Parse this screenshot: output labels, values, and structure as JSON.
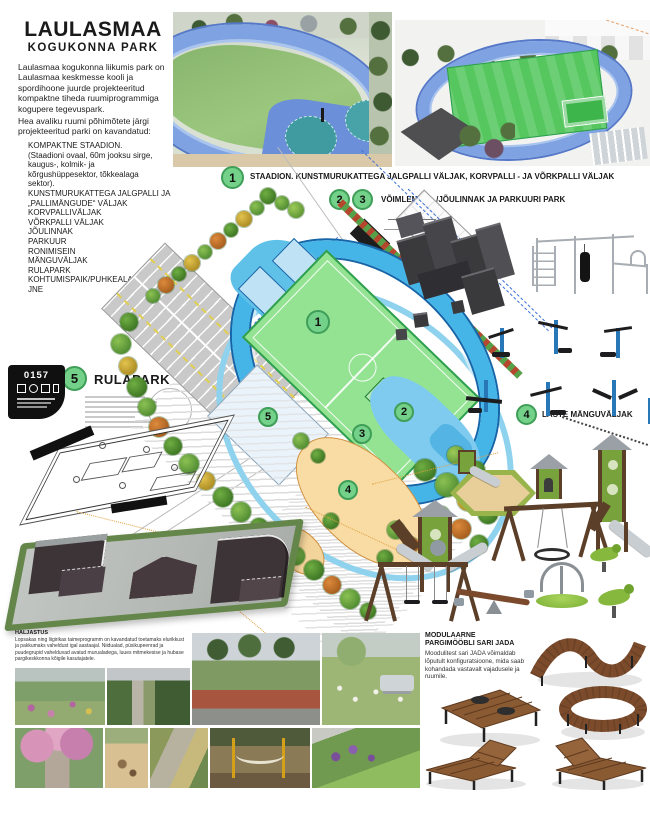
{
  "poster": {
    "title1": "LAULASMAA",
    "title2": "KOGUKONNA PARK",
    "intro1": "Laulasmaa kogukonna liikumis park on Laulasmaa keskmesse kooli ja spordihoone juurde projekteeritud kompaktne tiheda ruumiprogrammiga kogupere tegevuspark.",
    "intro2": "Hea avaliku ruumi põhimõtete järgi projekteeritud parki on kavandatud:",
    "features": [
      "KOMPAKTNE STAADION.",
      "(Staadioni ovaal, 60m jooksu sirge,",
      "kaugus-, kolmik- ja",
      "kõrgushüppesektor, tõkkealaga",
      "sektor).",
      "KUNSTMURUKATTEGA JALGPALLI JA",
      "„PALLIMÄNGUDE“ VÄLJAK",
      "KORVPALLIVÄLJAK",
      "VÕRKPALLI VÄLJAK",
      "JÕULINNAK",
      "PARKUUR",
      "RONIMISEIN",
      "MÄNGUVÄLJAK",
      "RULAPARK",
      "KOHTUMISPAIK/PUHKEALA",
      "JNE"
    ]
  },
  "sections": {
    "s1": {
      "num": "1",
      "label": "STAADION. KUNSTMURUKATTEGA JALGPALLI VÄLJAK, KORVPALLI - JA VÕRKPALLI VÄLJAK"
    },
    "s23": {
      "num_a": "2",
      "num_b": "3",
      "label": "VÕIMLEMISE- /JÕULINNAK JA PARKUURI PARK"
    },
    "s4": {
      "num": "4",
      "label": "LASTE MÄNGUVÄLJAK"
    },
    "s5": {
      "num": "5",
      "label": "RULAPARK"
    }
  },
  "markers": {
    "m1": "1",
    "m2": "2",
    "m3": "3",
    "m4": "4",
    "m5": "5"
  },
  "badge": {
    "code": "0157"
  },
  "greenery": {
    "heading": "HALJASTUS",
    "body": "Lopsakas ning liigirikas taimeprogramm on kavandatud toetamaks elurikkust ja pakkumaks vaheldust igal aastaajal. Niidualad, püsikupeenrad ja puudegrupid vahelduvad avatud murualadega, luues mitmekesise ja hubase pargikeskkonna kõigile kasutajatele."
  },
  "furniture": {
    "h1": "MODULAARNE",
    "h2": "PARGIMÖÖBLI SARI JADA",
    "body": "Moodulitest sari JADA võimaldab lõputult konfiguratsioone, mida saab kohandada vastavalt vajadusele ja ruumile."
  },
  "colors": {
    "marker_green": "#74d189",
    "marker_ring": "#3f9e57",
    "track_blue": "#45b4e6",
    "field_green": "#93e393",
    "court_blue": "#bfe3f5",
    "sand_orange": "#f8dca4",
    "parking_gray": "#c9c9c9",
    "wood_brown": "#7b4b2c"
  }
}
